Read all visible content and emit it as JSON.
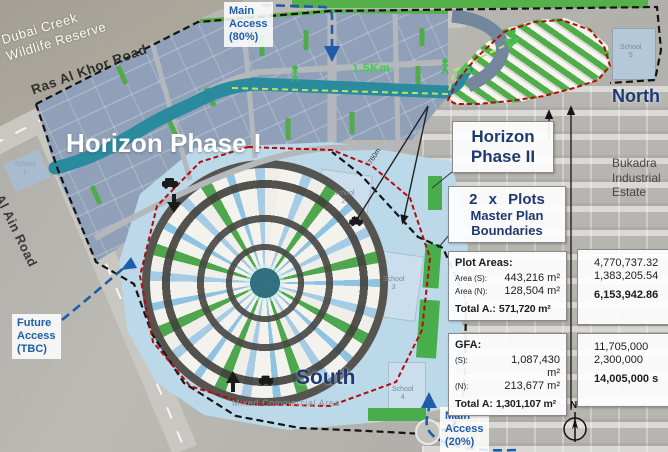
{
  "colors": {
    "navy": "#1e3a70",
    "access_blue": "#1f5dab",
    "green": "#4fae49",
    "teal": "#2a8a9e",
    "boundary_red": "#b30b0b",
    "water": "#bcd9e9"
  },
  "labels": {
    "wildlife_reserve": "Dubai Creek\nWildlife  Reserve",
    "ras_al_khor": "Ras Al Khor Road",
    "al_ain_road": "Al Ain Road",
    "phase1": "Horizon Phase I",
    "north": "North",
    "south": "South",
    "bukadra": "Bukadra\nIndustrial\nEstate",
    "mixed_commercial": "Mixed Commercial Area",
    "canal_distance": "1.5Km",
    "plot_distance": "760m",
    "compass_n": "N"
  },
  "access": {
    "main_80": "Main\nAccess\n(80%)",
    "main_20": "Main\nAccess\n(20%)",
    "future": "Future\nAccess\n(TBC)"
  },
  "schools": {
    "s1": "School\n1",
    "s2": "School\n2",
    "s3": "School\n3",
    "s4": "School\n4",
    "s5": "School\n5"
  },
  "callouts": {
    "phase2_title": "Horizon\nPhase II",
    "plots_line1": "2 x Plots",
    "plots_line2": "Master Plan",
    "plots_line3": "Boundaries"
  },
  "plot_areas": {
    "title": "Plot Areas:",
    "rows": [
      {
        "label": "Area (S):",
        "m2": "443,216 m²",
        "sqft": "4,770,737.32"
      },
      {
        "label": "Area (N):",
        "m2": "128,504 m²",
        "sqft": "1,383,205.54"
      }
    ],
    "total_label": "Total A.:",
    "total_m2": "571,720 m²",
    "total_sqft": "6,153,942.86"
  },
  "gfa": {
    "title": "GFA:",
    "rows": [
      {
        "label": "(S):",
        "m2": "1,087,430 m²",
        "sqft": "11,705,000"
      },
      {
        "label": "(N):",
        "m2": "213,677 m²",
        "sqft": "2,300,000"
      }
    ],
    "total_label": "Total A:",
    "total_m2": "1,301,107 m²",
    "total_sqft": "14,005,000 s"
  }
}
